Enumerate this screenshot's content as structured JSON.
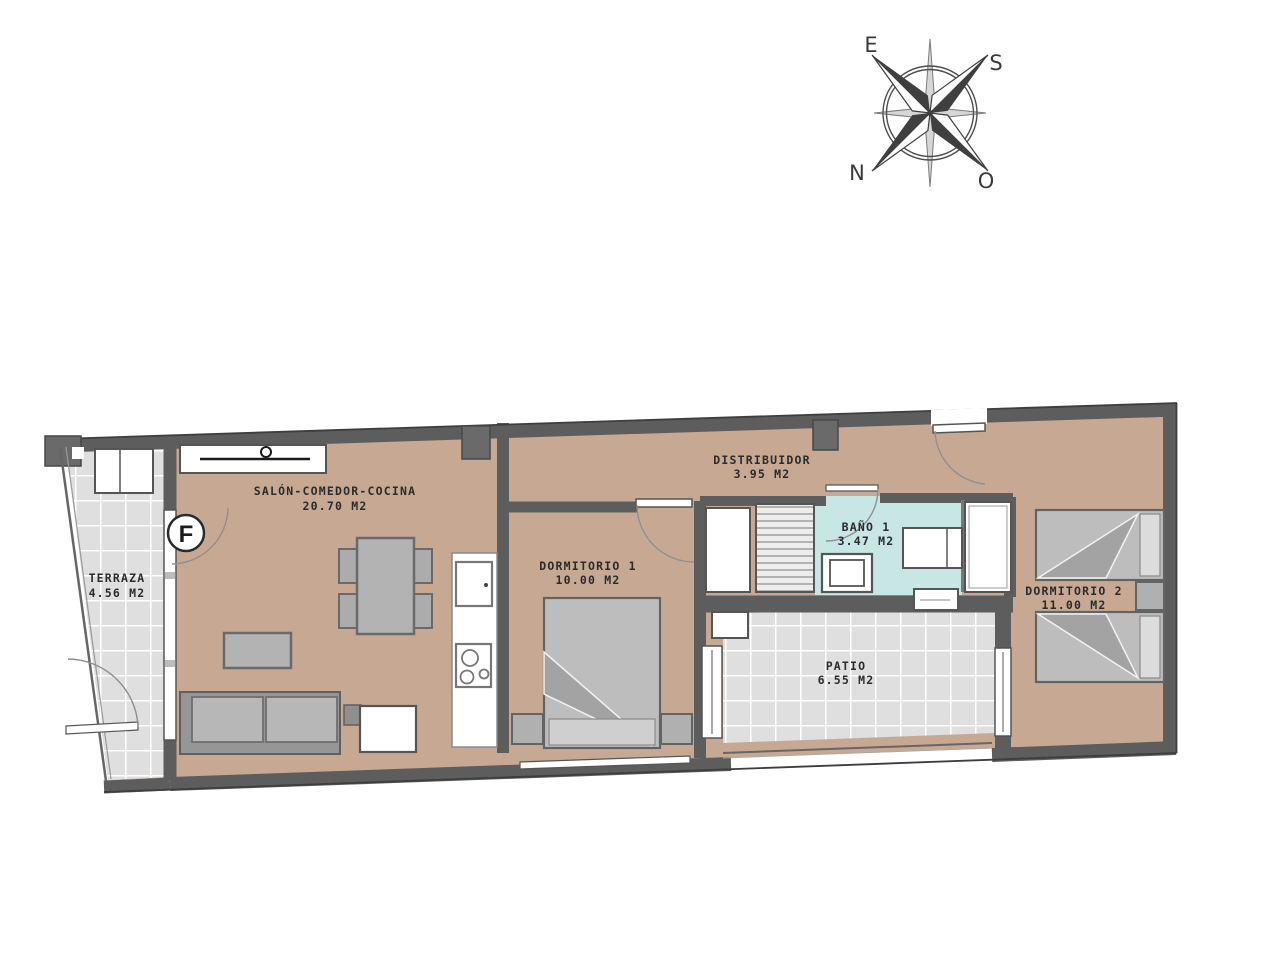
{
  "page": {
    "background": "#ffffff",
    "type": "apartment floor plan"
  },
  "compass": {
    "labels": {
      "e": "E",
      "s": "S",
      "n": "N",
      "o": "O"
    }
  },
  "plan": {
    "unit_letter": "F",
    "rooms": {
      "salon": {
        "name": "SALÓN-COMEDOR-COCINA",
        "area": "20.70 M2"
      },
      "terraza": {
        "name": "TERRAZA",
        "area": "4.56 M2"
      },
      "dormitorio1": {
        "name": "DORMITORIO 1",
        "area": "10.00 M2"
      },
      "distribuidor": {
        "name": "DISTRIBUIDOR",
        "area": "3.95 M2"
      },
      "bano": {
        "name": "BAÑO 1",
        "area": "3.47 M2"
      },
      "patio": {
        "name": "PATIO",
        "area": "6.55 M2"
      },
      "dormitorio2": {
        "name": "DORMITORIO 2",
        "area": "11.00 M2"
      }
    },
    "colors": {
      "floor": "#c7a993",
      "tile": "#dfdfdf",
      "tile_line": "#ffffff",
      "bath": "#c8e6e3",
      "wall": "#5d5d5d",
      "furniture": "#b3b3b3",
      "fixture": "#ffffff"
    }
  }
}
